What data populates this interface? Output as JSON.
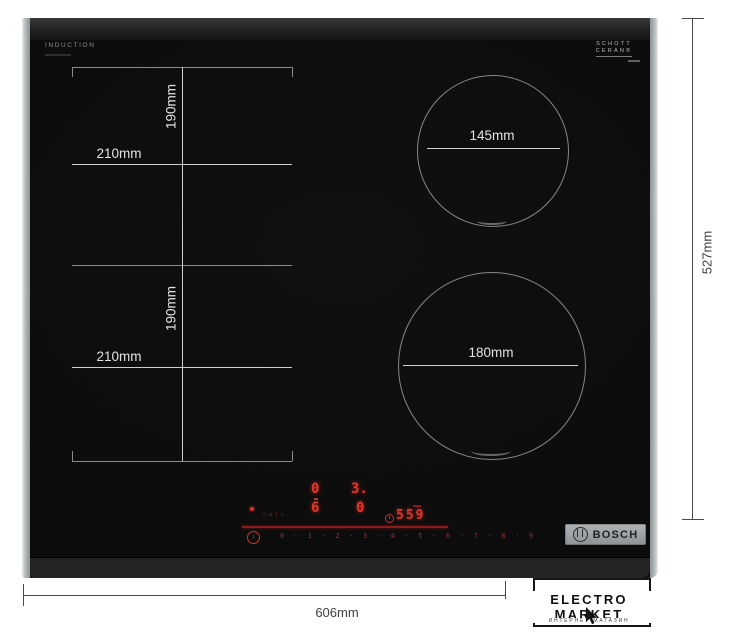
{
  "cooktop": {
    "surface_label": "INDUCTION",
    "glass_brand": {
      "line1": "SCHOTT",
      "line2": "CERAN®"
    },
    "brand_badge": "BOSCH"
  },
  "zones": {
    "left_top": {
      "width": "210mm",
      "height": "190mm"
    },
    "left_bottom": {
      "width": "210mm",
      "height": "190mm"
    },
    "right_top": {
      "diameter": "145mm"
    },
    "right_bottom": {
      "diameter": "180mm"
    }
  },
  "outer_dimensions": {
    "width": "606mm",
    "height": "527mm"
  },
  "control_panel": {
    "zone_displays": {
      "top_left": "0",
      "top_right": "3.",
      "bottom_left": "6",
      "bottom_right": "0"
    },
    "timer_display": "559",
    "function_icons": "□ ≡ | ⌂",
    "info_icon": "i",
    "power_scale_text": "0 · 1 · 2 · 3 · 4 · 5 · 6 · 7 · 8 · 9",
    "power_scale_values": [
      "0",
      "1",
      "2",
      "3",
      "4",
      "5",
      "6",
      "7",
      "8",
      "9"
    ]
  },
  "watermark": {
    "title": "ELECTRO MARKET",
    "subtitle": "ИНТЕРНЕТ-МАГАЗИН"
  },
  "colors": {
    "led_red": "#e3352c",
    "led_dim_red": "#9c2b24",
    "measure_line": "#cfcfcf",
    "outline_gray": "#8c8c8c",
    "annotation_gray": "#3f3f3f"
  }
}
